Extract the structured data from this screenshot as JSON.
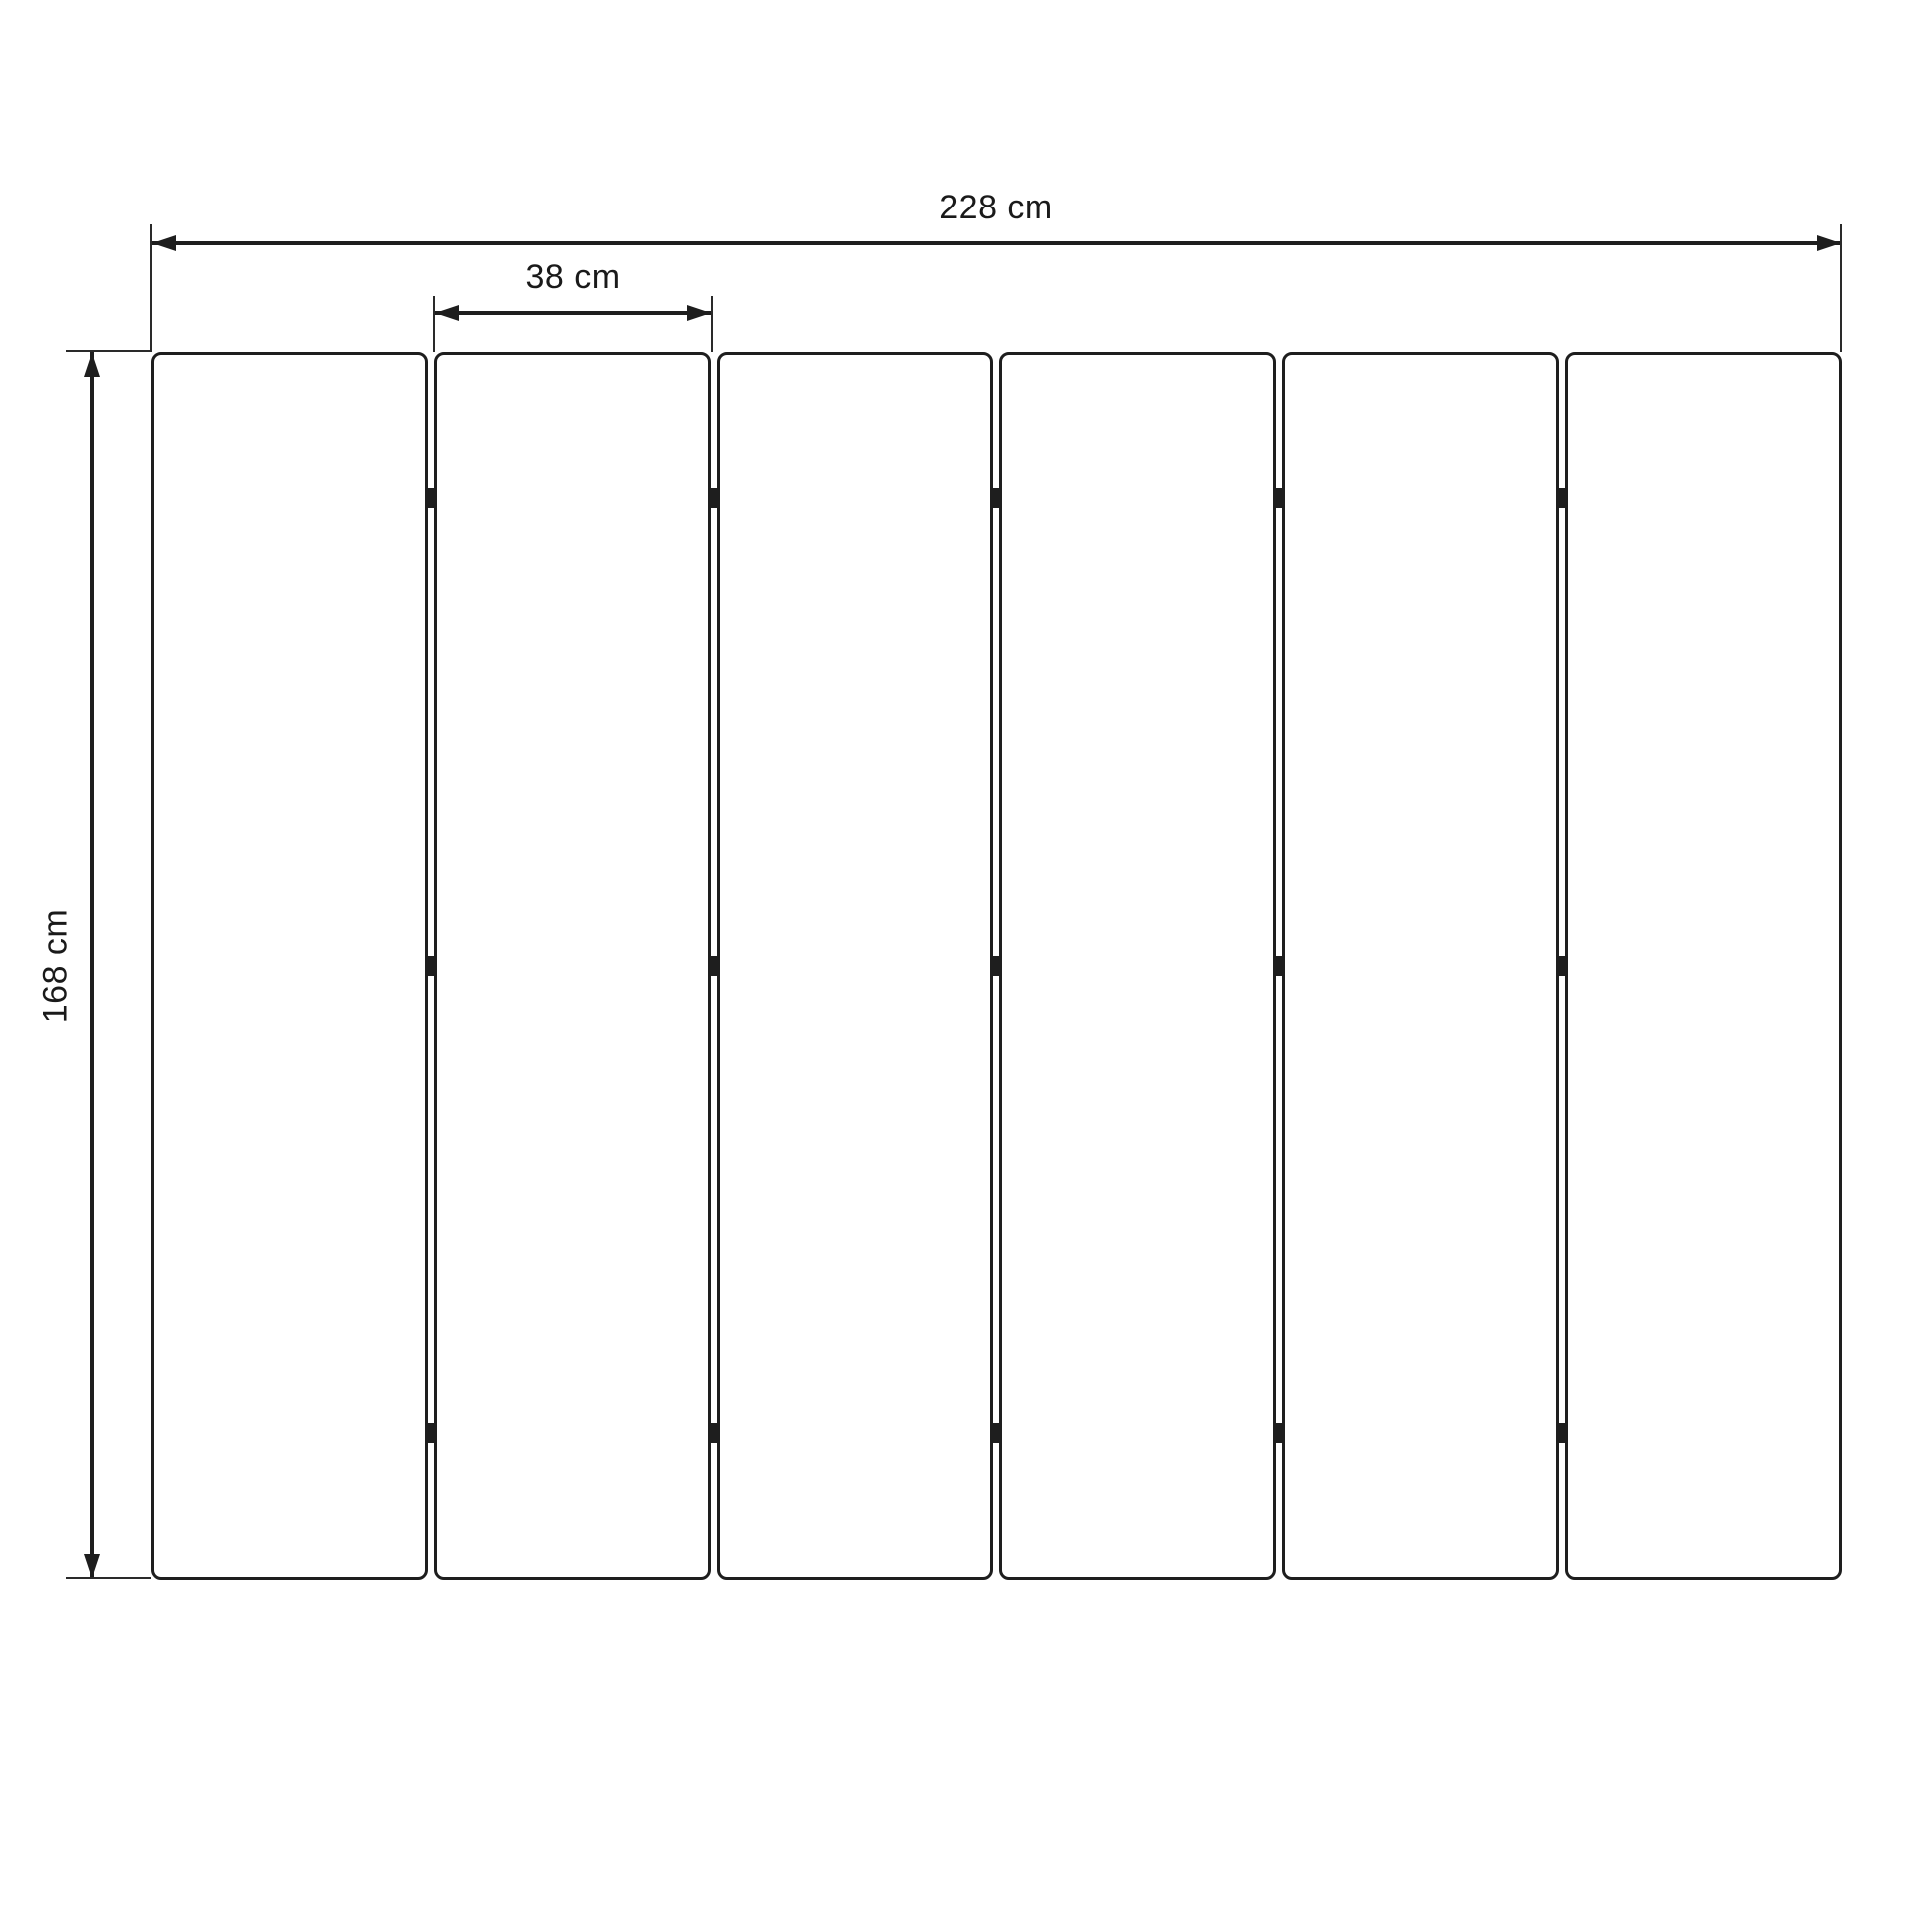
{
  "diagram": {
    "type": "technical-dimension-drawing",
    "subject": "six-panel folding screen, front elevation",
    "dimensions": {
      "total_width": {
        "label": "228 cm",
        "value": 228,
        "unit": "cm"
      },
      "panel_width": {
        "label": "38 cm",
        "value": 38,
        "unit": "cm"
      },
      "height": {
        "label": "168 cm",
        "value": 168,
        "unit": "cm"
      }
    },
    "panels": {
      "count": 6,
      "junctions": 5,
      "hinges_per_junction": 3
    },
    "colors": {
      "line": "#1e1e1e",
      "background": "#ffffff",
      "text": "#1a1a1a"
    }
  }
}
